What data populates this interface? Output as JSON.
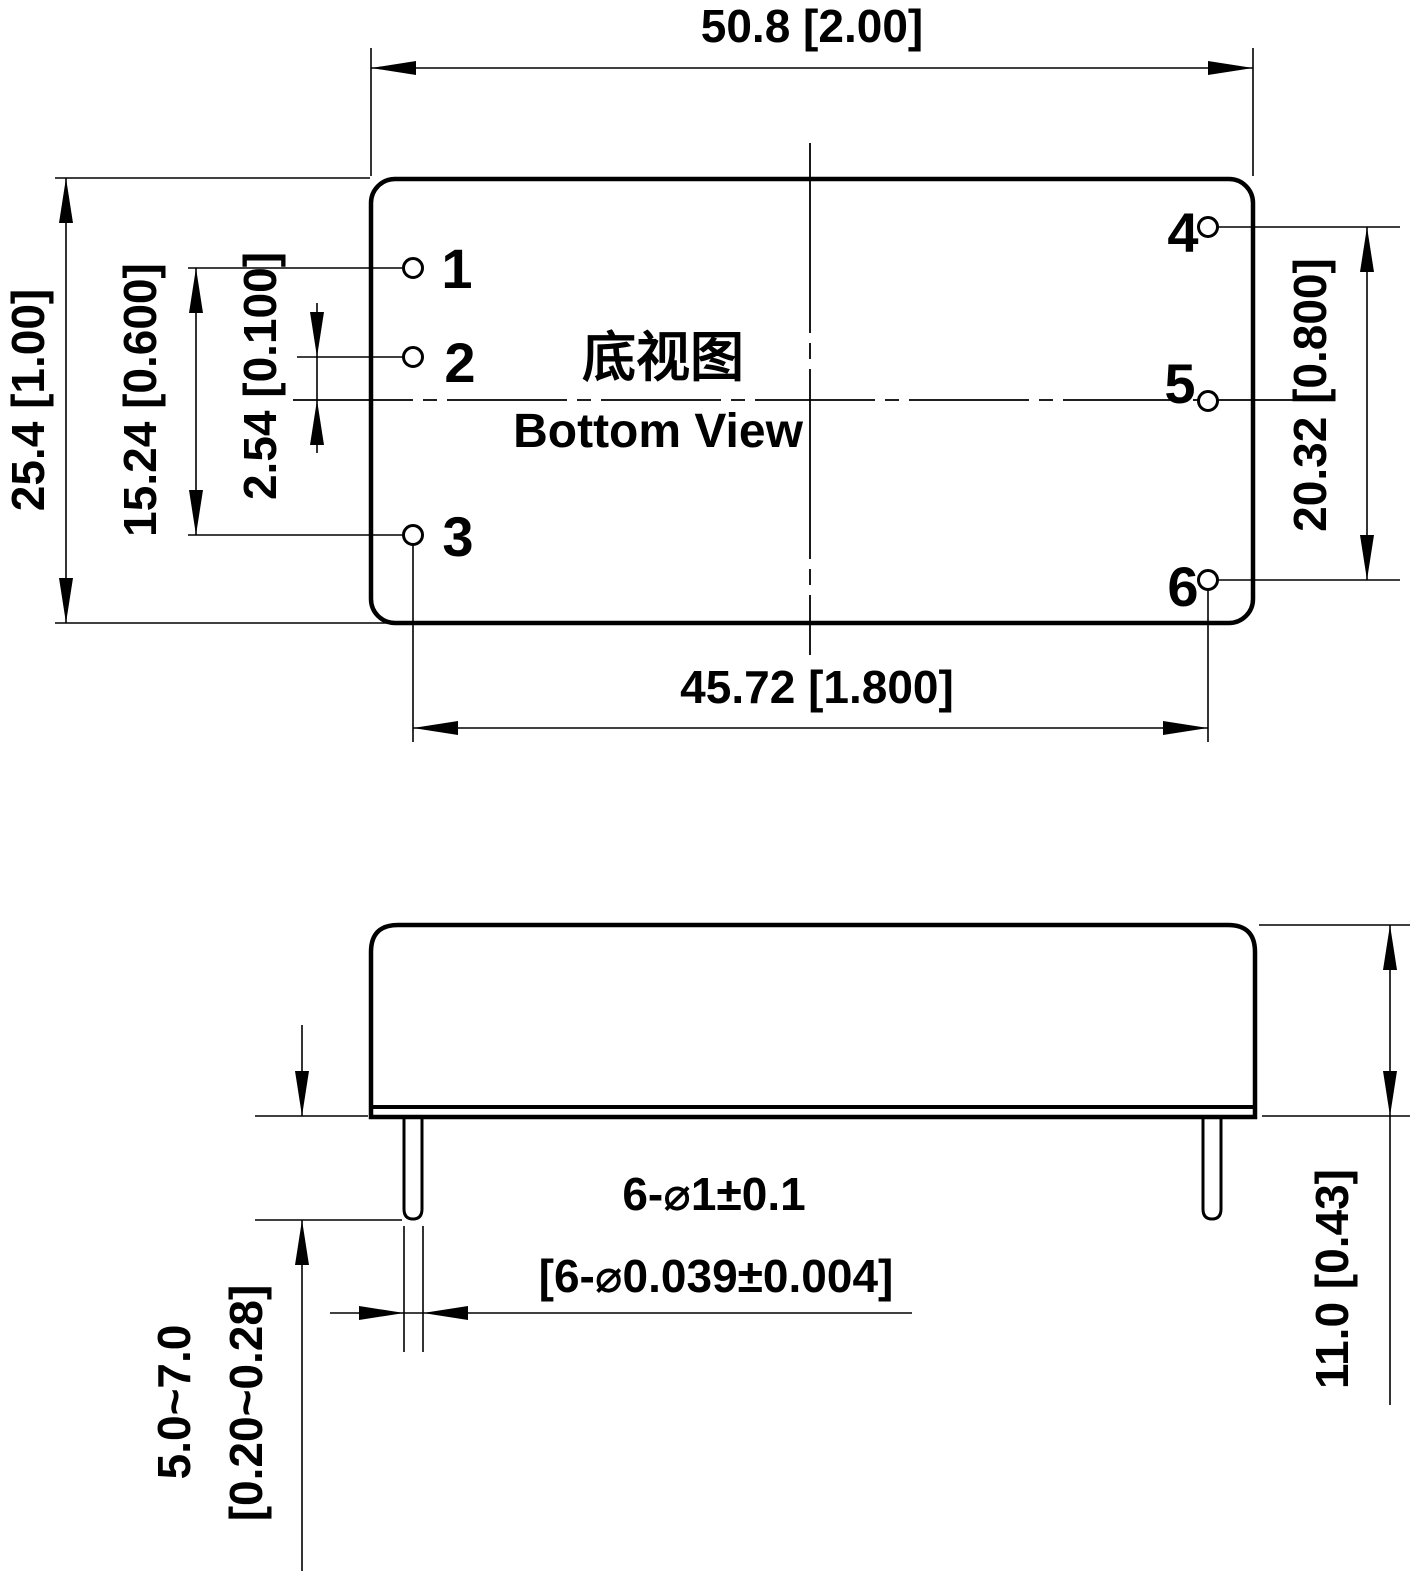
{
  "document": {
    "view_title_cn": "底视图",
    "view_title_en": "Bottom View"
  },
  "dimensions": {
    "overall_width": "50.8 [2.00]",
    "overall_depth": "25.4 [1.00]",
    "pin1_pin3_spacing": "15.24 [0.600]",
    "pin2_center_offset": "2.54 [0.100]",
    "pin4_pin6_spacing": "20.32 [0.800]",
    "pin_row_spacing": "45.72 [1.800]",
    "case_height": "11.0 [0.43]",
    "pin_length_mm": "5.0~7.0",
    "pin_length_inch": "[0.20~0.28]",
    "pin_diameter_mm": "6-⌀1±0.1",
    "pin_diameter_inch": "[6-⌀0.039±0.004]"
  },
  "pins": {
    "labels": [
      "1",
      "2",
      "3",
      "4",
      "5",
      "6"
    ]
  },
  "colors": {
    "line": "#000000",
    "background": "#ffffff"
  }
}
